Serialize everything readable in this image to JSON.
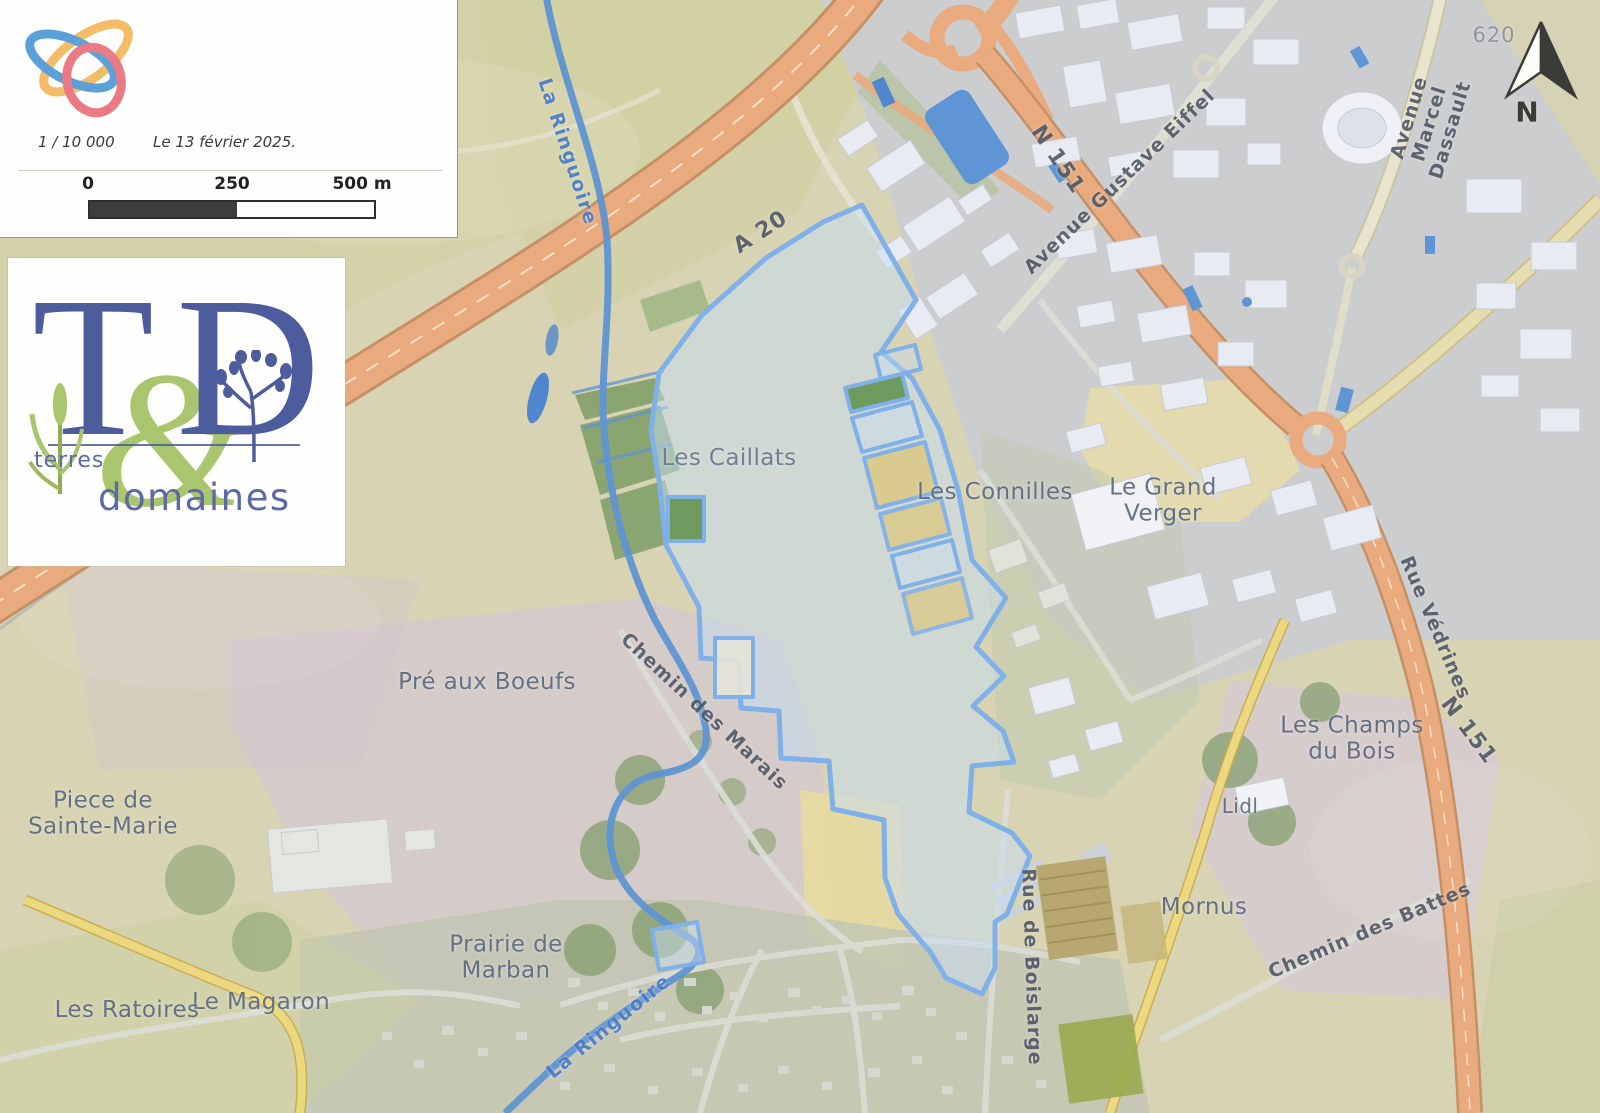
{
  "infobox": {
    "scale": "1 / 10 000",
    "date": "Le 13 février 2025.",
    "scalebar": {
      "start": "0",
      "middle": "250",
      "end": "500 m"
    }
  },
  "brand": {
    "letter_t": "T",
    "ampersand": "&",
    "letter_d": "D",
    "word_top": "terres",
    "word_bottom": "domaines"
  },
  "compass": {
    "north_label": "N"
  },
  "spot_elevation": "620",
  "places": {
    "les_caillats": "Les Caillats",
    "les_connilles": "Les Connilles",
    "le_grand_verger": "Le Grand\nVerger",
    "pre_aux_boeufs": "Pré aux Boeufs",
    "piece_de_sainte_marie": "Piece de\nSainte-Marie",
    "les_champs_du_bois": "Les Champs\ndu Bois",
    "lidl": "Lidl",
    "mornus": "Mornus",
    "prairie_de_marban": "Prairie de\nMarban",
    "le_magaron": "Le Magaron",
    "les_ratoires": "Les Ratoires"
  },
  "roads": {
    "a20": "A 20",
    "n151_top": "N 151",
    "n151_right": "N 151",
    "avenue_gustave_eiffel": "Avenue Gustave Eiffel",
    "avenue_marcel_dassault": "Avenue Marcel Dassault",
    "rue_vedrines": "Rue Védrines",
    "chemin_des_battes": "Chemin des Battes",
    "chemin_des_marais": "Chemin des Marais",
    "rue_de_boislarge": "Rue de Boislarge"
  },
  "rivers": {
    "la_ringuoire_top": "La Ringuoire",
    "la_ringuoire_bottom": "La Ringuoire"
  },
  "colors": {
    "parcel_outline": "#7fb0e8",
    "parcel_fill": "rgba(199,222,243,0.5)",
    "highway": "#e9ab7e",
    "river": "#5f93d2",
    "place_label": "#5f6c81",
    "road_label": "#4d5564",
    "river_label": "#4a7cc8"
  }
}
